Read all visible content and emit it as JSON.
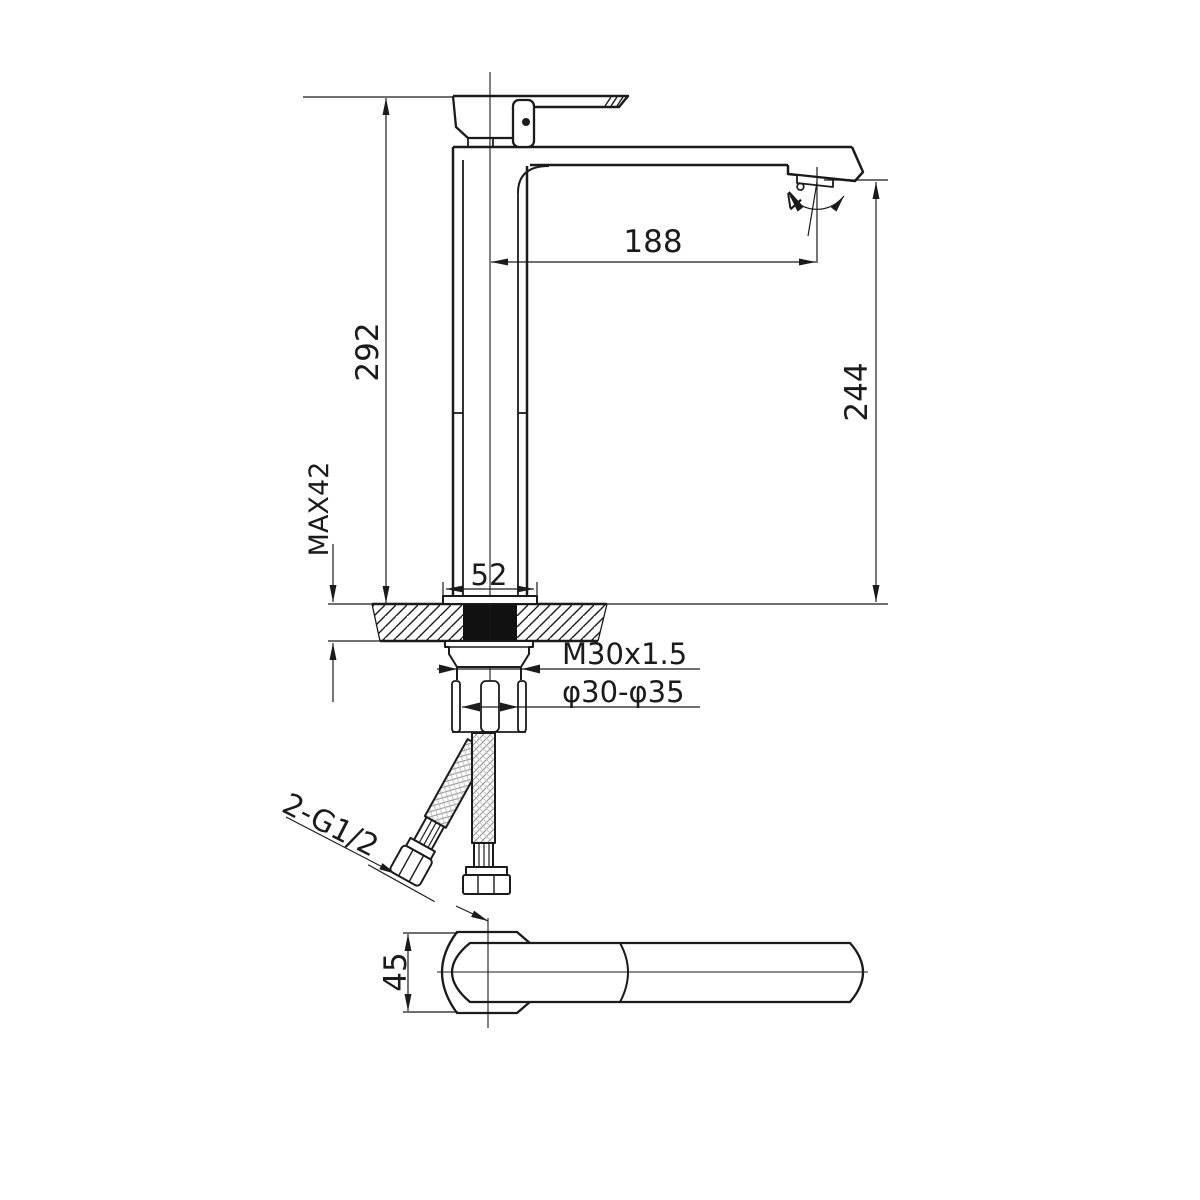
{
  "title": "faucet-dimensional-drawing",
  "dimensions": {
    "overall_height": "292",
    "spout_reach": "188",
    "spout_outlet_height": "244",
    "max_deck_thickness": "MAX42",
    "base_width": "52",
    "mounting_thread": "M30x1.5",
    "hole_diameter_range": "φ30-φ35",
    "inlet_connections": "2-G1/2",
    "base_depth": "45",
    "aerator_angle": "4°"
  },
  "colors": {
    "line": "#1b1b1b",
    "braid": "#9b9b9b",
    "background": "#ffffff",
    "shank_fill": "#111111"
  }
}
